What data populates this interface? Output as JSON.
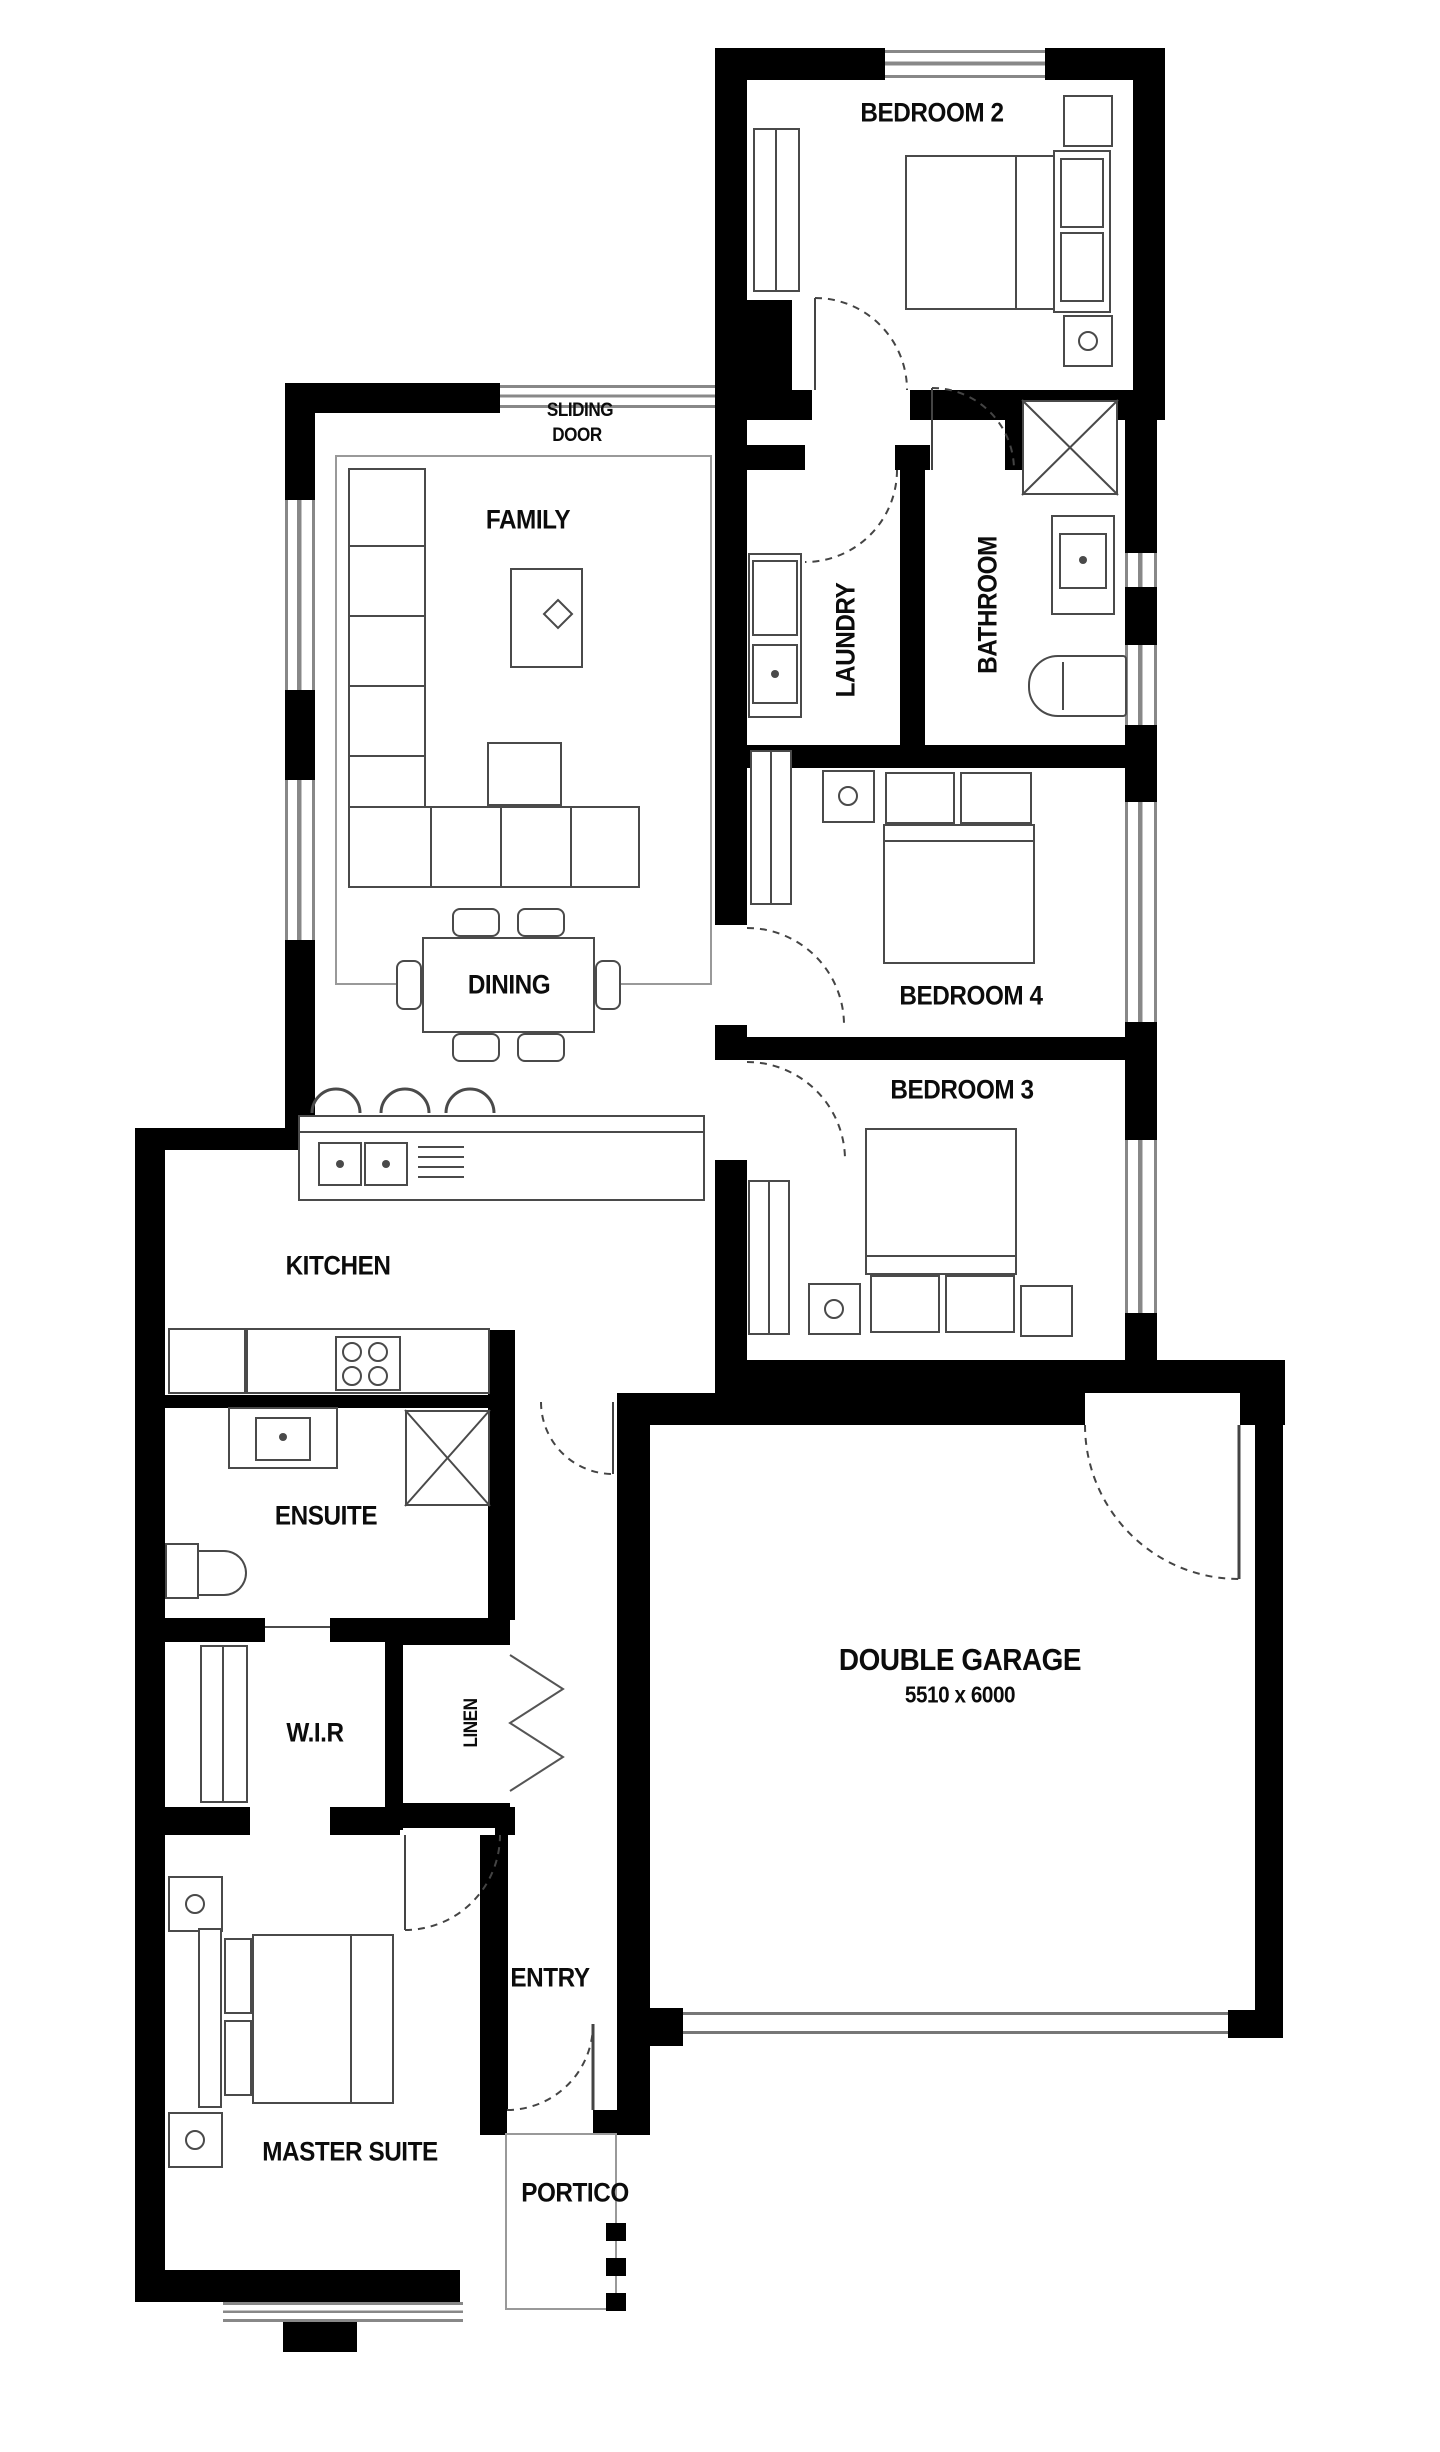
{
  "rooms": [
    {
      "id": "bedroom-2",
      "label": "BEDROOM 2"
    },
    {
      "id": "family",
      "label": "FAMILY"
    },
    {
      "id": "dining",
      "label": "DINING"
    },
    {
      "id": "kitchen",
      "label": "KITCHEN"
    },
    {
      "id": "laundry",
      "label": "LAUNDRY"
    },
    {
      "id": "bathroom",
      "label": "BATHROOM"
    },
    {
      "id": "bedroom-4",
      "label": "BEDROOM 4"
    },
    {
      "id": "bedroom-3",
      "label": "BEDROOM 3"
    },
    {
      "id": "ensuite",
      "label": "ENSUITE"
    },
    {
      "id": "wir",
      "label": "W.I.R"
    },
    {
      "id": "linen",
      "label": "LINEN"
    },
    {
      "id": "double-garage",
      "label": "DOUBLE GARAGE",
      "dimensions": "5510 x 6000"
    },
    {
      "id": "entry",
      "label": "ENTRY"
    },
    {
      "id": "master-suite",
      "label": "MASTER SUITE"
    },
    {
      "id": "portico",
      "label": "PORTICO"
    }
  ],
  "annotations": {
    "sliding_door": {
      "line1": "SLIDING",
      "line2": "DOOR"
    }
  },
  "colors": {
    "wall": "#000000",
    "furniture_line": "#4a4a4a",
    "window_line": "#888888"
  }
}
